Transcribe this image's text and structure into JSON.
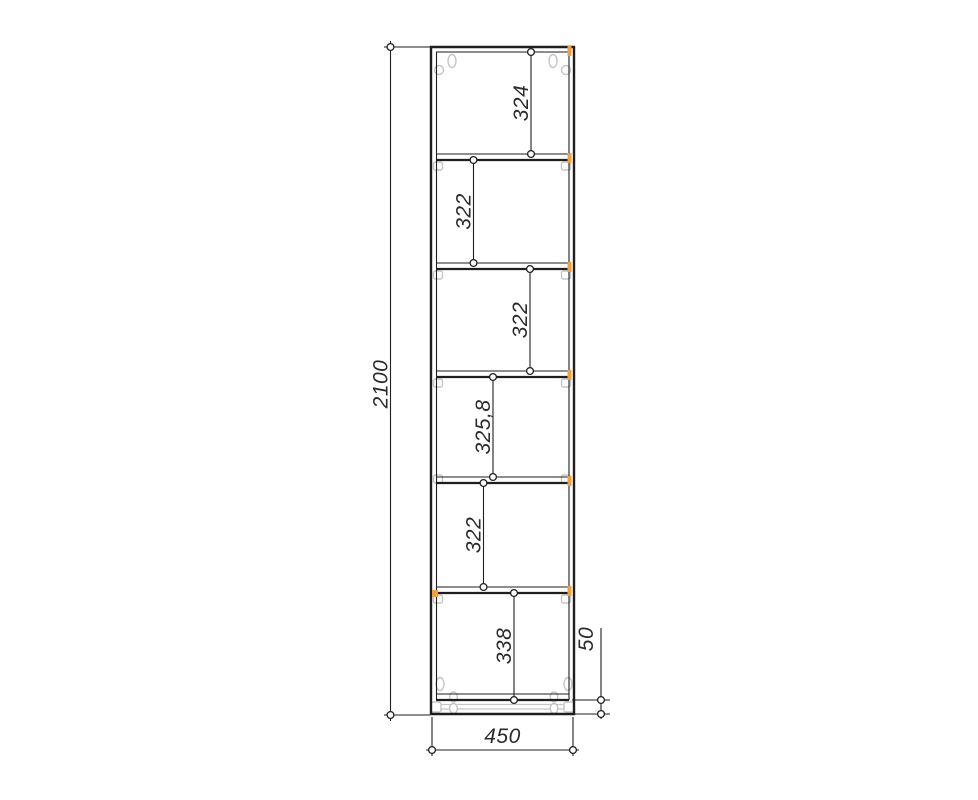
{
  "drawing": {
    "kind": "tall-cabinet-front-elevation",
    "labels": {
      "overall_height": "2100",
      "overall_width": "450",
      "plinth_height": "50"
    },
    "sections": [
      {
        "label": "324"
      },
      {
        "label": "322"
      },
      {
        "label": "322"
      },
      {
        "label": "325,8"
      },
      {
        "label": "322"
      },
      {
        "label": "338"
      }
    ],
    "colors": {
      "line": "#1e1e1e",
      "fitting": "#c5c5c5",
      "edge_marker": "#f2a03d",
      "background": "#ffffff"
    }
  }
}
